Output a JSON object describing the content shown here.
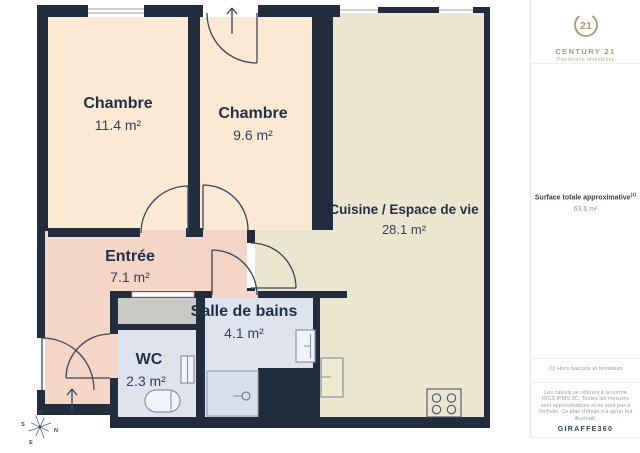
{
  "plan": {
    "rooms": [
      {
        "name": "Chambre",
        "area": "11.4 m²"
      },
      {
        "name": "Chambre",
        "area": "9.6 m²"
      },
      {
        "name": "Cuisine / Espace de vie",
        "area": "28.1 m²"
      },
      {
        "name": "Entrée",
        "area": "7.1 m²"
      },
      {
        "name": "Salle de bains",
        "area": "4.1 m²"
      },
      {
        "name": "WC",
        "area": "2.3 m²"
      }
    ],
    "compass": {
      "n": "N",
      "s": "S",
      "e": "E",
      "w": "W"
    },
    "colors": {
      "wall": "#212c3d",
      "bedroom": "#fbe9d4",
      "kitchen": "#ebe6cf",
      "hall": "#f5d5c5",
      "bath": "#dfe3ee",
      "closet": "#cbc9c5",
      "shower": "#d9dfec",
      "logo_gold": "#ab9b72",
      "label_dark": "#22304a"
    }
  },
  "sidebar": {
    "logo": {
      "number": "21",
      "brand": "CENTURY 21",
      "agency": "Patrimoine Immobilier"
    },
    "surface": {
      "label": "Surface totale approximative",
      "sup": "(1)",
      "value": "63.6 m²"
    },
    "note": "(1) Hors balcons et terrasses",
    "legal": "Les calculs se réfèrent à la norme RICS IPMS 3C. Toutes les mesures sont approximatives et ne sont pas à l'échelle. Ce plan d'étage n'a qu'un but illustratif.",
    "brand": "GIRAFFE360"
  }
}
